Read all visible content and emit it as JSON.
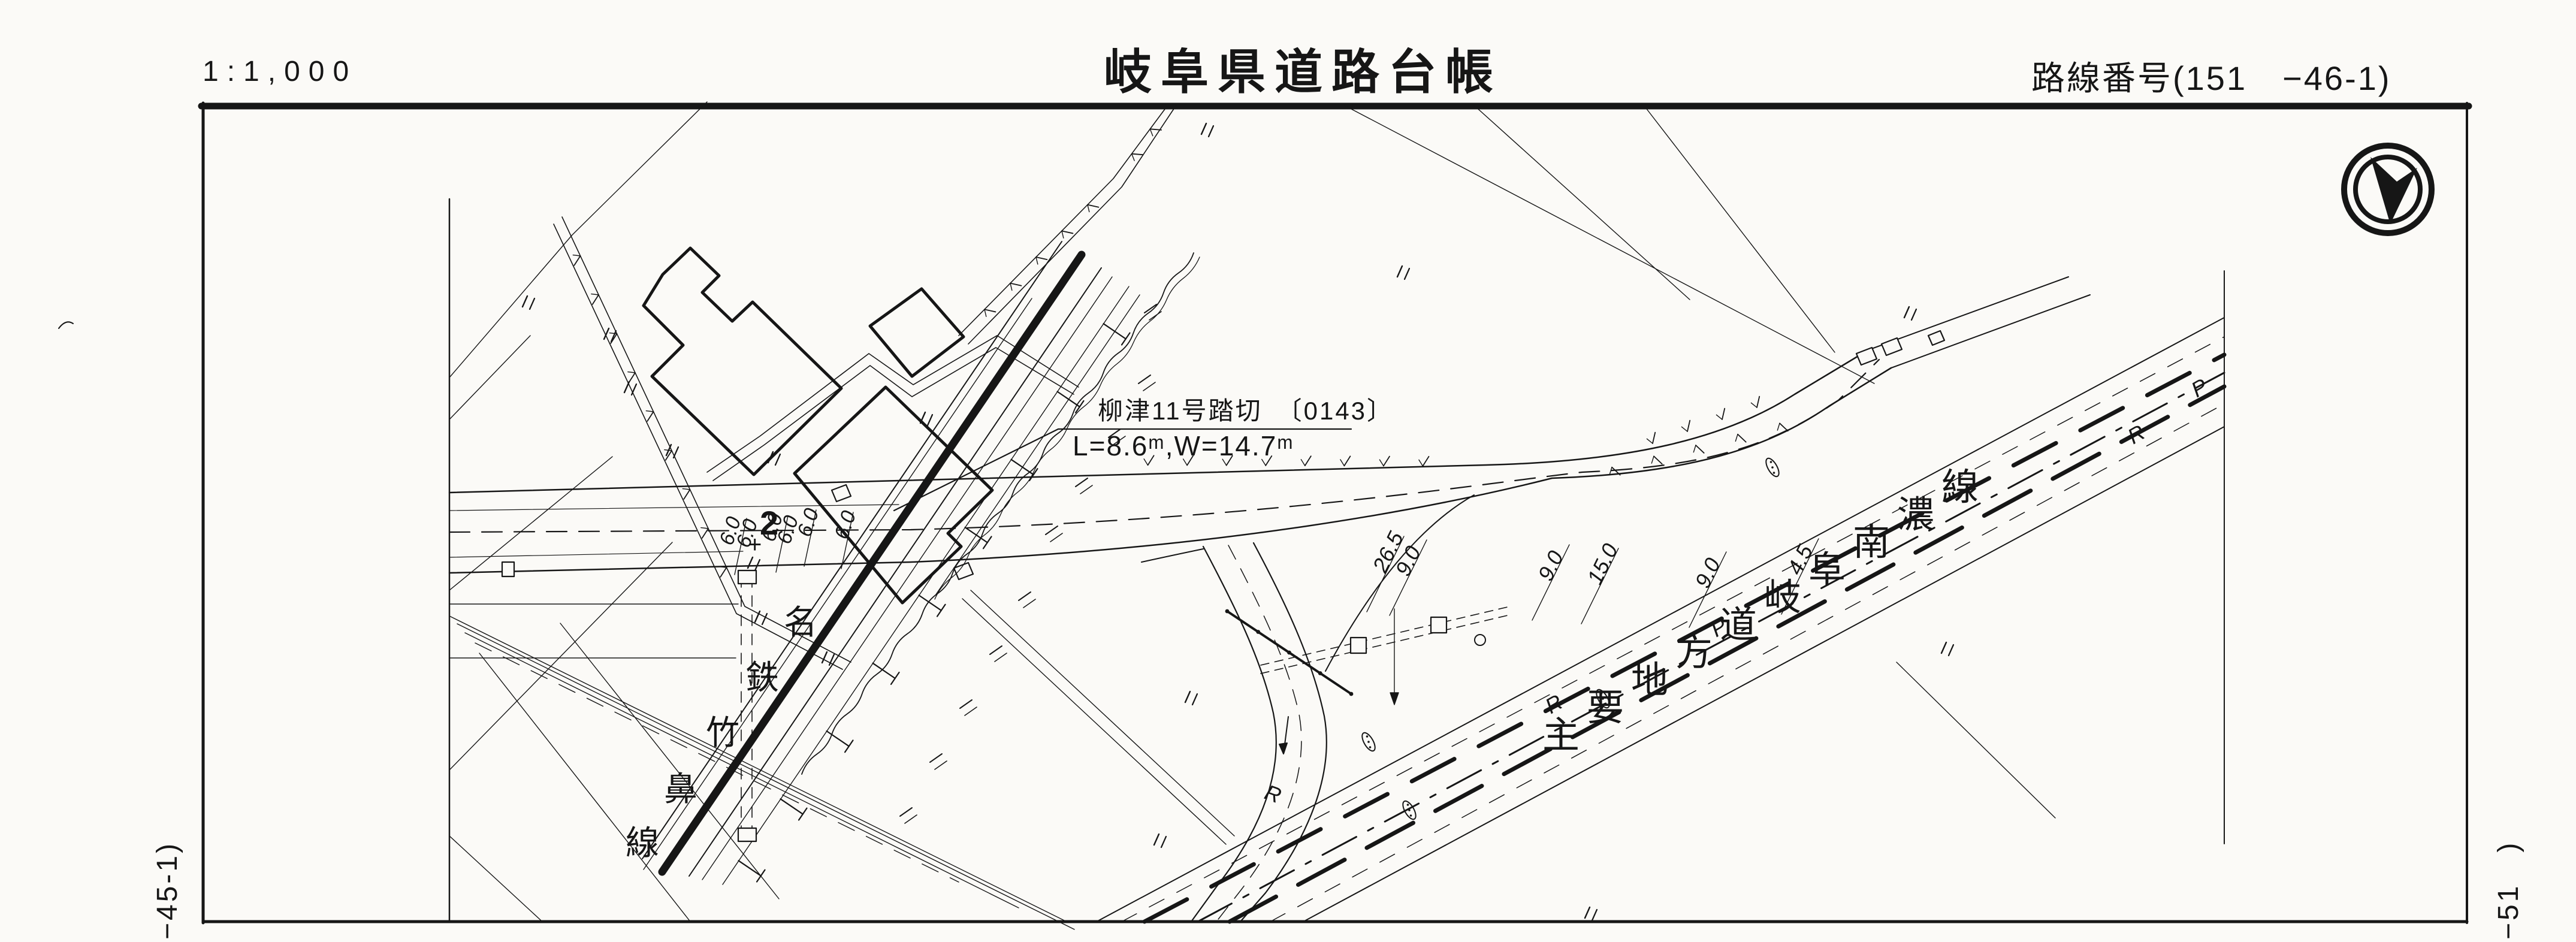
{
  "page": {
    "background": "#fbfaf7",
    "ink": "#161616"
  },
  "header": {
    "scale_label": "1:1,000",
    "title": "岐阜県道路台帳",
    "route_number": "路線番号(151　−46-1)"
  },
  "margins": {
    "left_sheet_code": "−45-1)",
    "right_sheet_code": "−51　)"
  },
  "map": {
    "north_icon": "north-arrow-icon",
    "railway_label": "名鉄竹鼻線",
    "main_road_label": "主要地方道岐阜南濃線",
    "crossing_label": {
      "title": "柳津11号踏切　〔0143〕",
      "size": "L=8.6ᵐ,W=14.7ᵐ"
    },
    "station_marker": {
      "number": "2",
      "plus": "+"
    },
    "crossing_widths": [
      "6.0",
      "6.0",
      "6.0",
      "6.0",
      "6.0",
      "6.0"
    ],
    "section_widths": [
      "26.5",
      "9.0",
      "9.0",
      "15.0",
      "9.0",
      "4.5"
    ],
    "road_letters": [
      "R",
      "R",
      "P",
      "R",
      "P"
    ],
    "field_mark_symbol": "〃"
  }
}
